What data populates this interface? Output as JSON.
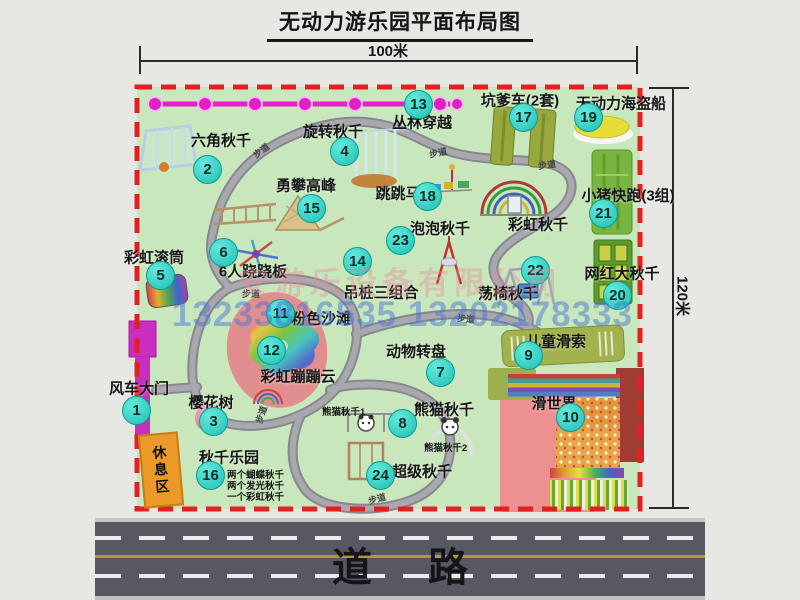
{
  "title": "无动力游乐园平面布局图",
  "dimensions": {
    "width": "100米",
    "height": "120米"
  },
  "road": {
    "label": "道路"
  },
  "watermark": {
    "company": "安游乐设备有限公司",
    "phones": "13233816535 13202178333"
  },
  "rest_area": "休息区",
  "path_label": "步道",
  "labels": {
    "rainbow_swing": "彩虹秋千",
    "panda_swing_1": "熊猫秋千1",
    "panda_swing_2": "熊猫秋千2"
  },
  "swing_park_notes": [
    "两个蝴蝶秋千",
    "两个发光秋千",
    "一个彩虹秋千"
  ],
  "markers": [
    {
      "num": "1",
      "label": "风车大门"
    },
    {
      "num": "2",
      "label": "六角秋千"
    },
    {
      "num": "3",
      "label": "樱花树"
    },
    {
      "num": "4",
      "label": "旋转秋千"
    },
    {
      "num": "5",
      "label": "彩虹滚筒"
    },
    {
      "num": "6",
      "label": "6人跷跷板"
    },
    {
      "num": "7",
      "label": "动物转盘"
    },
    {
      "num": "8",
      "label": "熊猫秋千"
    },
    {
      "num": "9",
      "label": "儿童滑索"
    },
    {
      "num": "10",
      "label": "滑世界"
    },
    {
      "num": "11",
      "label": "粉色沙滩"
    },
    {
      "num": "12",
      "label": "彩虹蹦蹦云"
    },
    {
      "num": "13",
      "label": "丛林穿越"
    },
    {
      "num": "14",
      "label": "吊桩三组合"
    },
    {
      "num": "15",
      "label": "勇攀高峰"
    },
    {
      "num": "16",
      "label": "秋千乐园"
    },
    {
      "num": "17",
      "label": "坑爹车(2套)"
    },
    {
      "num": "18",
      "label": "跳跳马"
    },
    {
      "num": "19",
      "label": "无动力海盗船"
    },
    {
      "num": "20",
      "label": "网红大秋千"
    },
    {
      "num": "21",
      "label": "小猪快跑(3组)"
    },
    {
      "num": "22",
      "label": "荡椅秋千"
    },
    {
      "num": "23",
      "label": "泡泡秋千"
    },
    {
      "num": "24",
      "label": "超级秋千"
    }
  ]
}
